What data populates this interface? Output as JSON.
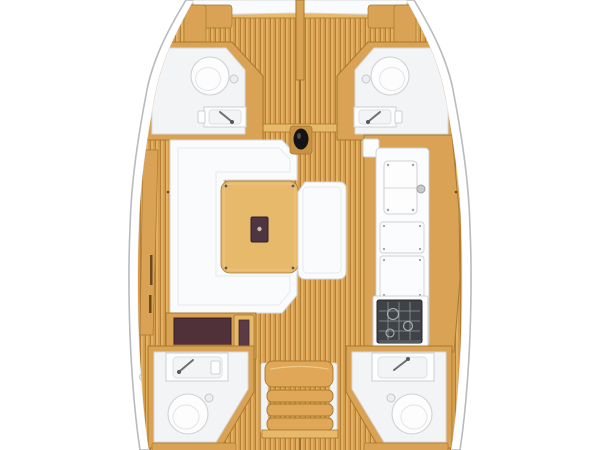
{
  "document": {
    "type": "yacht-interior-floor-plan",
    "view": "top-down"
  },
  "colors": {
    "background": "#ffffff",
    "hull_fill": "#ffffff",
    "hull_stroke": "#b8babc",
    "floor_base": "#d59a4c",
    "floor_light": "#e3b162",
    "floor_seam": "#b07b31",
    "wall_wood": "#d9a254",
    "wall_trim": "#a87a2e",
    "furniture_wood": "#e7b96b",
    "upholstery_white": "#fafbfc",
    "room_white": "#f3f4f6",
    "table_insert": "#4e3542",
    "chart_table": "#503039",
    "stove_top": "#3f4347",
    "mast": "#141414",
    "stair_cushion": "#dfa757"
  },
  "zones": {
    "hull": {
      "label": "Hull outline"
    },
    "bow_cabin": {
      "label": "Bow cabin V-berth",
      "elements": [
        "port mattress",
        "starboard mattress",
        "center divider",
        "side cushions"
      ]
    },
    "forward_head_port": {
      "label": "Forward head port",
      "fixtures": [
        "toilet",
        "shower drain",
        "sink with faucet"
      ]
    },
    "forward_head_starboard": {
      "label": "Forward head starboard",
      "fixtures": [
        "toilet",
        "shower drain",
        "sink with faucet"
      ]
    },
    "saloon": {
      "label": "Saloon",
      "furniture": [
        "U-shaped settee",
        "wood table with folding insert",
        "bench seat"
      ]
    },
    "mast": {
      "label": "Mast post"
    },
    "galley": {
      "label": "Galley",
      "equipment": [
        "double sink panel",
        "counter locker",
        "fridge locker",
        "gimbaled stove"
      ]
    },
    "chart_table": {
      "label": "Chart table"
    },
    "companionway": {
      "label": "Companionway steps"
    },
    "aft_head_port": {
      "label": "Aft head port",
      "fixtures": [
        "sink with faucet",
        "toilet",
        "shower drain"
      ]
    },
    "aft_head_starboard": {
      "label": "Aft head starboard",
      "fixtures": [
        "sink with faucet",
        "toilet",
        "shower drain"
      ]
    },
    "aft_area": {
      "label": "Aft berth edges and engine box"
    }
  }
}
